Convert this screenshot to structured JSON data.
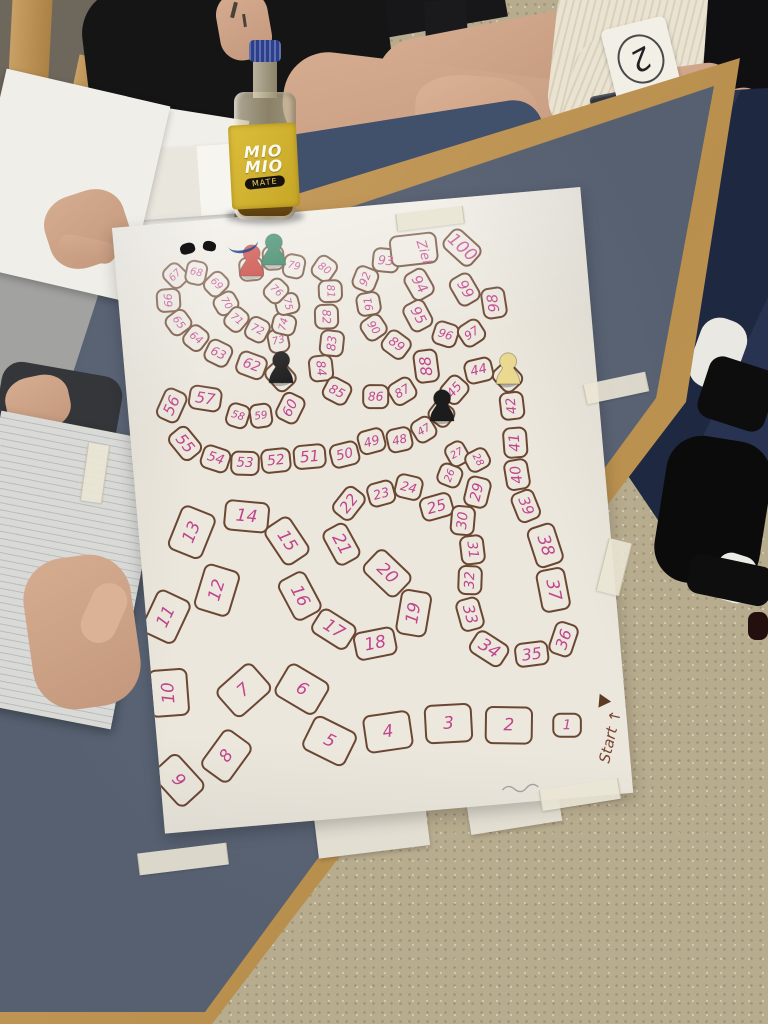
{
  "board": {
    "start_label": "Start ↑",
    "goal_label": "Ziel",
    "number_color": "#c0458c",
    "line_color": "#6b4733",
    "cell_fill": "#ece8de",
    "start_color": "#7a4530",
    "cells_nxy": [
      [
        1,
        410,
        535
      ],
      [
        2,
        352,
        530
      ],
      [
        3,
        292,
        523
      ],
      [
        4,
        231,
        526
      ],
      [
        5,
        172,
        530
      ],
      [
        6,
        149,
        476
      ],
      [
        7,
        91,
        472
      ],
      [
        8,
        68,
        536
      ],
      [
        9,
        18,
        556
      ],
      [
        10,
        16,
        468
      ],
      [
        11,
        20,
        392
      ],
      [
        12,
        73,
        370
      ],
      [
        13,
        53,
        310
      ],
      [
        14,
        109,
        299
      ],
      [
        15,
        147,
        327
      ],
      [
        16,
        155,
        383
      ],
      [
        17,
        186,
        419
      ],
      [
        18,
        226,
        437
      ],
      [
        19,
        267,
        410
      ],
      [
        20,
        244,
        368
      ],
      [
        21,
        201,
        335
      ],
      [
        22,
        212,
        295
      ],
      [
        23,
        245,
        288
      ],
      [
        24,
        273,
        284
      ],
      [
        25,
        299,
        306
      ],
      [
        26,
        315,
        276
      ],
      [
        27,
        324,
        255
      ],
      [
        28,
        344,
        263
      ],
      [
        29,
        341,
        295
      ],
      [
        30,
        324,
        322
      ],
      [
        31,
        331,
        352
      ],
      [
        32,
        326,
        382
      ],
      [
        33,
        323,
        416
      ],
      [
        34,
        339,
        452
      ],
      [
        35,
        381,
        461
      ],
      [
        36,
        414,
        449
      ],
      [
        37,
        408,
        399
      ],
      [
        38,
        404,
        354
      ],
      [
        39,
        388,
        313
      ],
      [
        40,
        382,
        281
      ],
      [
        41,
        383,
        249
      ],
      [
        42,
        383,
        212
      ],
      [
        43,
        381,
        183
      ],
      [
        44,
        353,
        174
      ],
      [
        45,
        327,
        191
      ],
      [
        46,
        312,
        214
      ],
      [
        47,
        293,
        228
      ],
      [
        48,
        268,
        236
      ],
      [
        49,
        240,
        235
      ],
      [
        50,
        212,
        246
      ],
      [
        51,
        177,
        245
      ],
      [
        52,
        143,
        246
      ],
      [
        53,
        112,
        246
      ],
      [
        54,
        83,
        239
      ],
      [
        55,
        54,
        221
      ],
      [
        56,
        44,
        182
      ],
      [
        57,
        78,
        178
      ],
      [
        58,
        109,
        198
      ],
      [
        59,
        132,
        200
      ],
      [
        60,
        162,
        195
      ],
      [
        61,
        155,
        162
      ],
      [
        62,
        127,
        149
      ],
      [
        63,
        95,
        134
      ],
      [
        64,
        74,
        117
      ],
      [
        65,
        58,
        100
      ],
      [
        66,
        50,
        77
      ],
      [
        67,
        59,
        53
      ],
      [
        68,
        80,
        52
      ],
      [
        69,
        99,
        65
      ],
      [
        70,
        107,
        85
      ],
      [
        71,
        116,
        102
      ],
      [
        72,
        136,
        114
      ],
      [
        73,
        156,
        127
      ],
      [
        74,
        163,
        111
      ],
      [
        75,
        168,
        91
      ],
      [
        76,
        158,
        77
      ],
      [
        77,
        135,
        53
      ],
      [
        78,
        158,
        44
      ],
      [
        79,
        178,
        54
      ],
      [
        80,
        208,
        59
      ],
      [
        81,
        212,
        82
      ],
      [
        82,
        206,
        107
      ],
      [
        83,
        209,
        134
      ],
      [
        84,
        196,
        158
      ],
      [
        85,
        210,
        182
      ],
      [
        86,
        248,
        191
      ],
      [
        87,
        275,
        188
      ],
      [
        88,
        301,
        165
      ],
      [
        89,
        273,
        141
      ],
      [
        90,
        252,
        122
      ],
      [
        91,
        249,
        98
      ],
      [
        92,
        248,
        73
      ],
      [
        93,
        270,
        56
      ],
      [
        94,
        301,
        83
      ],
      [
        95,
        297,
        114
      ],
      [
        96,
        323,
        135
      ],
      [
        97,
        349,
        136
      ],
      [
        98,
        374,
        108
      ],
      [
        99,
        346,
        92
      ],
      [
        100,
        347,
        50
      ]
    ],
    "goal_pos": {
      "x": 308,
      "y": 51
    },
    "start_pos": {
      "x": 452,
      "y": 550
    },
    "pawns": [
      {
        "name": "red-pawn",
        "cell": 77,
        "color": "#c02a1f"
      },
      {
        "name": "green-pawn",
        "cell": 78,
        "color": "#17714a"
      },
      {
        "name": "black-pawn-upper",
        "cell": 61,
        "color": "#1c1c1c"
      },
      {
        "name": "black-pawn-mid",
        "cell": 46,
        "color": "#1c1c1c"
      },
      {
        "name": "yellow-pawn",
        "cell": 43,
        "color": "#ead98f"
      }
    ]
  },
  "bottle": {
    "brand_top": "MIO",
    "brand_bottom": "MIO",
    "badge": "MATE",
    "label_color": "#d2b12f",
    "cap_color": "#2b3f8c"
  },
  "player_tag": {
    "value": "2"
  },
  "table": {
    "surface_color": "#566070",
    "frame_color": "#c59c5e"
  },
  "floor": {
    "color": "#b8ac8e"
  }
}
